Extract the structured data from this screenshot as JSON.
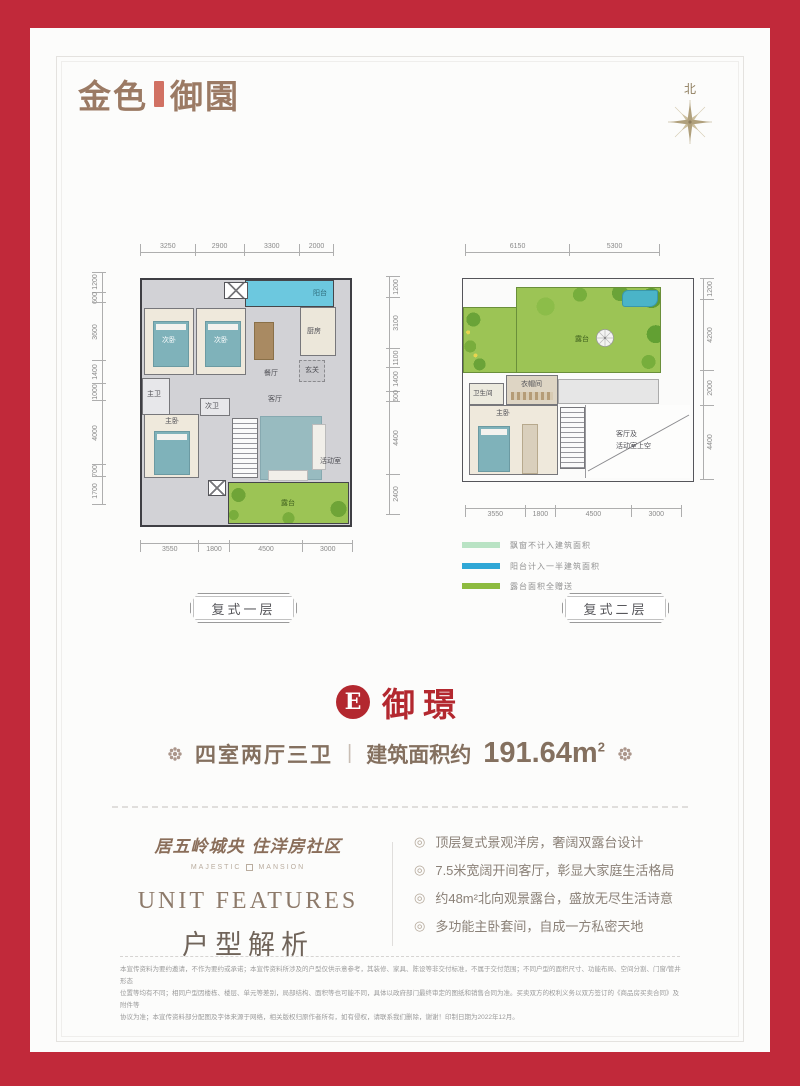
{
  "brand": {
    "logo_left": "金色",
    "logo_right": "御園",
    "accent_red": "#c1293a",
    "title_red": "#b3282f",
    "brand_brown": "#9b7a64"
  },
  "compass": {
    "north_label": "北"
  },
  "plans": {
    "plan1": {
      "label": "复式一层",
      "dims_top": [
        "3250",
        "2900",
        "3300",
        "2000"
      ],
      "dims_left": [
        "1200",
        "600",
        "3600",
        "1400",
        "1000",
        "4000",
        "700",
        "1700"
      ],
      "dims_right": [
        "1200",
        "3100",
        "1100",
        "1400",
        "600",
        "4400",
        "2400"
      ],
      "dims_bottom": [
        "3550",
        "1800",
        "4500",
        "3000"
      ],
      "rooms": {
        "balcony": "阳台",
        "kitchen": "厨房",
        "bedroom_a": "次卧",
        "bedroom_b": "次卧",
        "dining": "餐厅",
        "foyer": "玄关",
        "living": "客厅",
        "master_bath": "主卫",
        "second_bath": "次卫",
        "master_bedroom": "主卧",
        "activity": "活动室",
        "terrace": "露台"
      }
    },
    "plan2": {
      "label": "复式二层",
      "dims_top": [
        "6150",
        "5300"
      ],
      "dims_right": [
        "1200",
        "4200",
        "2000",
        "4400"
      ],
      "dims_bottom": [
        "3550",
        "1800",
        "4500",
        "3000"
      ],
      "rooms": {
        "terrace": "露台",
        "bathroom": "卫生间",
        "closet": "衣帽间",
        "master_bedroom": "主卧",
        "void_line1": "客厅及",
        "void_line2": "活动室上空"
      }
    }
  },
  "legend": {
    "items": [
      {
        "label": "飘窗不计入建筑面积",
        "color": "#b9e3c4"
      },
      {
        "label": "阳台计入一半建筑面积",
        "color": "#2fa7d6"
      },
      {
        "label": "露台面积全赠送",
        "color": "#8dbb3f"
      }
    ]
  },
  "unit": {
    "letter": "E",
    "name": "御璟",
    "layout": "四室两厅三卫",
    "area_prefix": "建筑面积约",
    "area_value": "191.64m",
    "area_sup": "2"
  },
  "features": {
    "slogan": "居五岭城央  住洋房社区",
    "sub_left": "MAJESTIC",
    "sub_right": "MANSION",
    "title_en": "UNIT FEATURES",
    "title_cn": "户型解析",
    "bullets": [
      "顶层复式景观洋房，奢阔双露台设计",
      "7.5米宽阔开间客厅，彰显大家庭生活格局",
      "约48m²北向观景露台，盛放无尽生活诗意",
      "多功能主卧套间，自成一方私密天地"
    ]
  },
  "disclaimer": {
    "lines": [
      "本宣传资料为要约邀请，不作为要约或承诺；本宣传资料所涉及的户型仅供示意参考，其装修、家具、陈设等非交付标准，不属于交付范围；不同户型的面积尺寸、功能布局、空间分割、门窗/管井形态",
      "位置等均有不同；相同户型因楼栋、楼层、单元等差别，局部结构、面积等也可能不同，具体以政府部门最终审定的图纸和销售合同为准。买卖双方的权利义务以双方签订的《商品房买卖合同》及附件等",
      "协议为准；本宣传资料部分配图及字体来源于网络，相关版权归原作者所有，如有侵权，请联系我们删除，谢谢！印制日期为2022年12月。"
    ]
  }
}
